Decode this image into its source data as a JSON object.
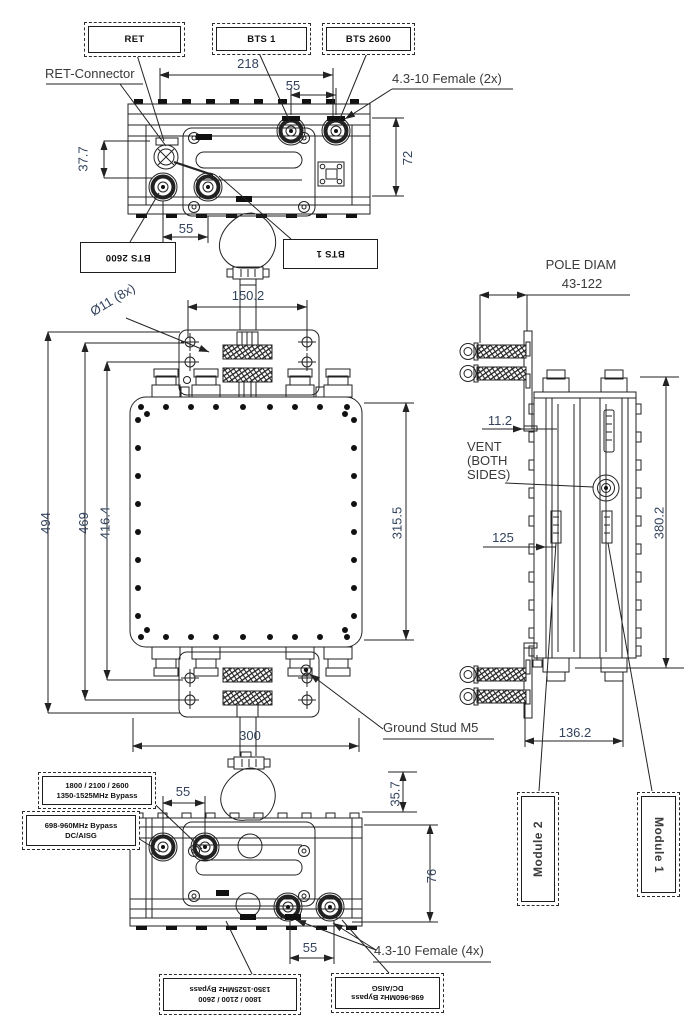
{
  "top": {
    "box_ret": "RET",
    "box_bts1": "BTS 1",
    "box_bts2600": "BTS 2600",
    "ret_connector": "RET-Connector",
    "female_2x": "4.3-10 Female (2x)",
    "dim_218": "218",
    "dim_55_a": "55",
    "dim_37_7": "37.7",
    "dim_72": "72",
    "dim_55_b": "55",
    "box_bts2600_flip": "BTS 2600",
    "box_bts1_flip": "BTS 1"
  },
  "front": {
    "hole_note": "Ø11 (8x)",
    "dim_150_2": "150.2",
    "dim_494": "494",
    "dim_469": "469",
    "dim_416_4": "416.4",
    "dim_315_5": "315.5",
    "dim_300": "300",
    "ground_stud": "Ground Stud M5"
  },
  "side": {
    "pole_diam_title": "POLE DIAM",
    "pole_diam_range": "43-122",
    "dim_11_2": "11.2",
    "vent_line1": "VENT",
    "vent_line2": "(BOTH",
    "vent_line3": "SIDES)",
    "dim_125": "125",
    "dim_380_2": "380.2",
    "dim_136_2": "136.2",
    "box_module2": "Module 2",
    "box_module1": "Module 1"
  },
  "bottom": {
    "box_high_l1": "1800 / 2100 / 2600",
    "box_high_l2": "1350-1525MHz Bypass",
    "box_low_l1": "698-960MHz Bypass",
    "box_low_l2": "DC/AISG",
    "dim_55_a": "55",
    "dim_35_7": "35.7",
    "dim_76": "76",
    "dim_55_b": "55",
    "female_4x": "4.3-10 Female (4x)",
    "box_high_flip_l1": "1800 / 2100 / 2600",
    "box_high_flip_l2": "1350-1525MHz Bypass",
    "box_low_flip_l1": "698-960MHz Bypass",
    "box_low_flip_l2": "DC/AISG"
  },
  "colors": {
    "line": "#222222",
    "dim_text": "#33435c",
    "label_text": "#111111"
  }
}
